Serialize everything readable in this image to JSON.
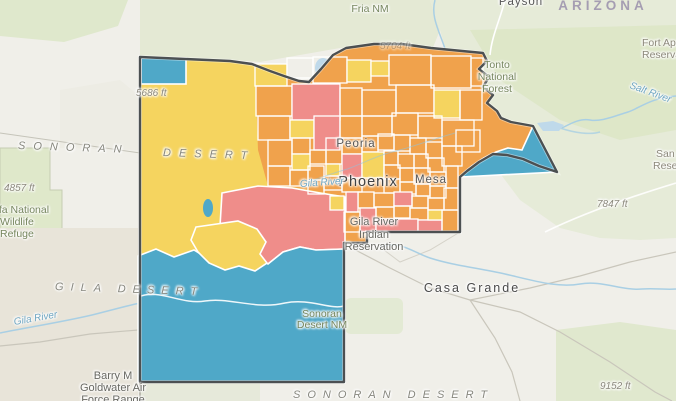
{
  "map": {
    "type": "choropleth-web-map",
    "region_shown": "Maricopa County, Arizona and surroundings",
    "palette": {
      "c_orange": "#F0A24C",
      "c_yellow": "#F5D45F",
      "c_red": "#EF8D8A",
      "c_blue": "#4FA8C8",
      "c_parcel_border": "#FFFFFF",
      "c_county_border": "#4C5052",
      "c_water": "#A9CFE4",
      "c_lake": "#BFD9EA",
      "c_terrain": "#F0EFE9",
      "c_green": "#E4EAD5",
      "c_forest": "#DCE6C6",
      "c_road": "#C9C6BB"
    },
    "legend_classes_visible": [
      "yellow",
      "orange",
      "red",
      "blue"
    ],
    "labels": [
      {
        "text": "Fria NM"
      },
      {
        "text": "Payson"
      },
      {
        "text": "ARIZONA"
      },
      {
        "text": "Fort Apache"
      },
      {
        "text": "Reservation"
      },
      {
        "text": "Tonto"
      },
      {
        "text": "National"
      },
      {
        "text": "Forest"
      },
      {
        "text": "Salt River"
      },
      {
        "text": "San Ca"
      },
      {
        "text": "Reserva"
      },
      {
        "text": "7847 ft"
      },
      {
        "text": "9152 ft"
      },
      {
        "text": "4857 ft"
      },
      {
        "text": "5686 ft"
      },
      {
        "text": "5704 ft"
      },
      {
        "text": "Kofa National"
      },
      {
        "text": "Wildlife"
      },
      {
        "text": "Refuge"
      },
      {
        "text": "SONORAN"
      },
      {
        "text": "DESERT"
      },
      {
        "text": "GILA DESERT"
      },
      {
        "text": "SONORAN DESERT"
      },
      {
        "text": "Peoria"
      },
      {
        "text": "Phoenix"
      },
      {
        "text": "Mesa"
      },
      {
        "text": "Gila River"
      },
      {
        "text": "Gila River"
      },
      {
        "text": "Indian"
      },
      {
        "text": "Reservation"
      },
      {
        "text": "Casa Grande"
      },
      {
        "text": "Barry M"
      },
      {
        "text": "Goldwater Air"
      },
      {
        "text": "Force Range"
      },
      {
        "text": "Sonoran"
      },
      {
        "text": "Desert NM"
      },
      {
        "text": "Gila River"
      }
    ],
    "parcels": [
      [
        255,
        64,
        32,
        22,
        "y"
      ],
      [
        287,
        58,
        26,
        20,
        "n"
      ],
      [
        313,
        57,
        34,
        26,
        "n"
      ],
      [
        347,
        60,
        24,
        22,
        "y"
      ],
      [
        371,
        61,
        18,
        15,
        "y"
      ],
      [
        389,
        55,
        42,
        30,
        "n"
      ],
      [
        431,
        56,
        40,
        32,
        "n"
      ],
      [
        471,
        58,
        12,
        28,
        "n"
      ],
      [
        256,
        86,
        36,
        30,
        "n"
      ],
      [
        292,
        84,
        48,
        36,
        "r"
      ],
      [
        340,
        88,
        22,
        28,
        "n"
      ],
      [
        362,
        90,
        34,
        26,
        "n"
      ],
      [
        396,
        85,
        38,
        28,
        "n"
      ],
      [
        434,
        90,
        26,
        28,
        "y"
      ],
      [
        460,
        90,
        22,
        30,
        "n"
      ],
      [
        258,
        116,
        32,
        24,
        "n"
      ],
      [
        290,
        120,
        24,
        18,
        "y"
      ],
      [
        314,
        116,
        26,
        34,
        "r"
      ],
      [
        340,
        116,
        22,
        22,
        "n"
      ],
      [
        362,
        116,
        30,
        20,
        "n"
      ],
      [
        392,
        113,
        26,
        22,
        "n"
      ],
      [
        418,
        116,
        24,
        22,
        "n"
      ],
      [
        442,
        120,
        32,
        26,
        "n"
      ],
      [
        268,
        140,
        24,
        26,
        "n"
      ],
      [
        292,
        138,
        18,
        16,
        "n"
      ],
      [
        310,
        150,
        16,
        14,
        "n"
      ],
      [
        326,
        138,
        16,
        26,
        "n"
      ],
      [
        342,
        138,
        20,
        16,
        "n"
      ],
      [
        362,
        136,
        16,
        16,
        "n"
      ],
      [
        378,
        134,
        16,
        16,
        "n"
      ],
      [
        394,
        135,
        16,
        16,
        "n"
      ],
      [
        410,
        138,
        16,
        16,
        "n"
      ],
      [
        426,
        142,
        16,
        16,
        "n"
      ],
      [
        442,
        146,
        20,
        20,
        "n"
      ],
      [
        456,
        130,
        24,
        22,
        "n"
      ],
      [
        292,
        154,
        18,
        16,
        "y"
      ],
      [
        326,
        164,
        14,
        12,
        "y"
      ],
      [
        342,
        154,
        20,
        24,
        "r"
      ],
      [
        362,
        152,
        22,
        26,
        "y"
      ],
      [
        384,
        151,
        14,
        14,
        "n"
      ],
      [
        398,
        154,
        16,
        14,
        "n"
      ],
      [
        414,
        154,
        14,
        14,
        "n"
      ],
      [
        428,
        158,
        16,
        14,
        "n"
      ],
      [
        268,
        166,
        22,
        20,
        "n"
      ],
      [
        290,
        170,
        18,
        16,
        "n"
      ],
      [
        308,
        166,
        16,
        14,
        "n"
      ],
      [
        384,
        165,
        16,
        14,
        "n"
      ],
      [
        400,
        168,
        14,
        14,
        "n"
      ],
      [
        414,
        168,
        16,
        16,
        "n"
      ],
      [
        430,
        172,
        16,
        14,
        "n"
      ],
      [
        446,
        166,
        12,
        22,
        "n"
      ],
      [
        308,
        180,
        16,
        14,
        "n"
      ],
      [
        324,
        176,
        18,
        14,
        "n"
      ],
      [
        342,
        178,
        20,
        14,
        "n"
      ],
      [
        384,
        179,
        16,
        14,
        "n"
      ],
      [
        400,
        182,
        16,
        12,
        "n"
      ],
      [
        416,
        184,
        14,
        12,
        "n"
      ],
      [
        430,
        186,
        16,
        12,
        "n"
      ],
      [
        358,
        192,
        16,
        16,
        "n"
      ],
      [
        374,
        193,
        20,
        14,
        "n"
      ],
      [
        394,
        192,
        18,
        14,
        "r"
      ],
      [
        412,
        196,
        16,
        12,
        "n"
      ],
      [
        428,
        198,
        16,
        12,
        "n"
      ],
      [
        444,
        188,
        14,
        22,
        "n"
      ],
      [
        346,
        192,
        12,
        20,
        "r"
      ],
      [
        360,
        208,
        16,
        24,
        "r"
      ],
      [
        376,
        207,
        18,
        12,
        "n"
      ],
      [
        394,
        206,
        16,
        12,
        "n"
      ],
      [
        410,
        208,
        18,
        12,
        "n"
      ],
      [
        376,
        219,
        42,
        13,
        "r"
      ],
      [
        418,
        220,
        24,
        12,
        "r"
      ],
      [
        442,
        210,
        16,
        22,
        "n"
      ],
      [
        330,
        196,
        14,
        14,
        "y"
      ],
      [
        344,
        212,
        16,
        20,
        "n"
      ],
      [
        428,
        210,
        14,
        10,
        "y"
      ]
    ]
  }
}
